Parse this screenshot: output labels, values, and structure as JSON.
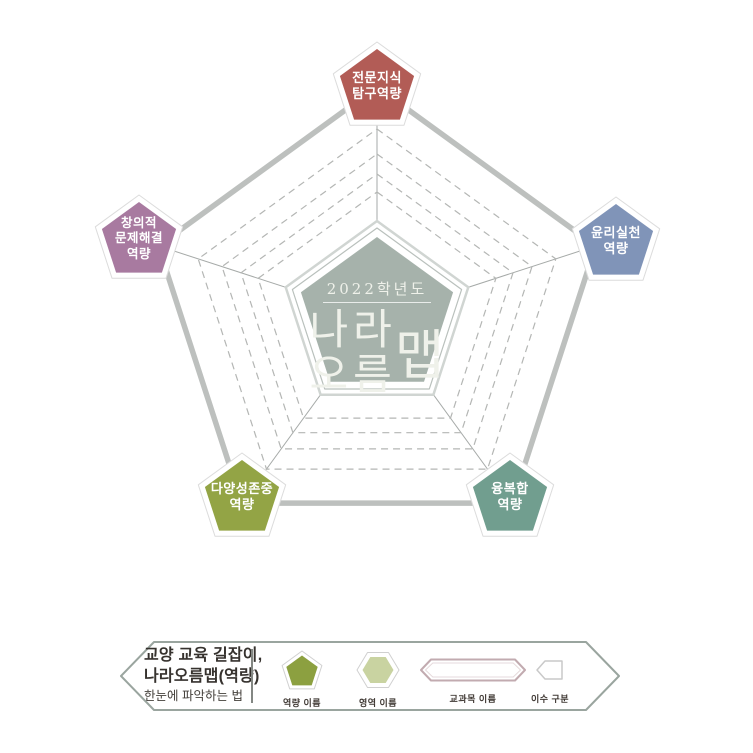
{
  "map": {
    "center": {
      "year": "2022학년도",
      "name_top": "나라",
      "name_bottom": "오름",
      "name_side": "맵"
    },
    "competencies": [
      {
        "position": "top",
        "color": "#b25c56",
        "lines": [
          "전문지식",
          "탐구역량"
        ]
      },
      {
        "position": "right",
        "color": "#8094b8",
        "lines": [
          "윤리실천",
          "역량"
        ]
      },
      {
        "position": "bottom-right",
        "color": "#719e8f",
        "lines": [
          "융복합",
          "역량"
        ]
      },
      {
        "position": "bottom-left",
        "color": "#93a445",
        "lines": [
          "다양성존중",
          "역량"
        ]
      },
      {
        "position": "left",
        "color": "#a87aa0",
        "lines": [
          "창의적",
          "문제해결",
          "역량"
        ]
      }
    ]
  },
  "legend": {
    "title_line1": "교양 교육 길잡이,",
    "title_line2": "나라오름맵(역량)",
    "title_line3": "한눈에 파악하는 법",
    "items": [
      {
        "shape": "pentagon",
        "label": "역량 이름",
        "fill": "#8ca040"
      },
      {
        "shape": "hexagon",
        "label": "영역 이름",
        "fill": "#c9d3a1"
      },
      {
        "shape": "pill",
        "label": "교과목 이름",
        "stroke": "#c2abb0"
      },
      {
        "shape": "tag",
        "label": "이수 구분",
        "stroke": "#c9c9c9"
      }
    ]
  },
  "colors": {
    "center_fill": "#a6b2ab",
    "outer_line": "#bdc0be",
    "spoke_line": "#a6aaa8",
    "dash_line": "#b4b6b4",
    "ring_outer": "#d0d5d2",
    "ring_inner": "#b9c0bc",
    "badge_halo": "#dcdcdc",
    "legend_border": "#9aa59f",
    "text_dark": "#36322e"
  }
}
